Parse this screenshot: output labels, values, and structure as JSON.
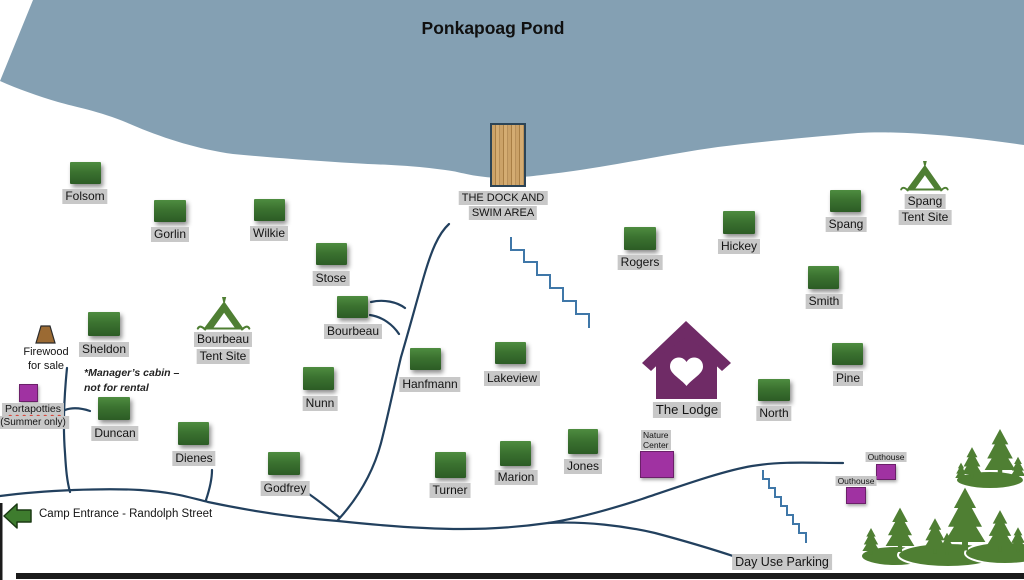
{
  "title": "Ponkapoag Pond",
  "dock": {
    "label_line1": "THE DOCK AND",
    "label_line2": "SWIM AREA"
  },
  "cabins": [
    {
      "name": "Folsom"
    },
    {
      "name": "Gorlin"
    },
    {
      "name": "Wilkie"
    },
    {
      "name": "Stose"
    },
    {
      "name": "Bourbeau"
    },
    {
      "name": "Rogers"
    },
    {
      "name": "Hickey"
    },
    {
      "name": "Spang"
    },
    {
      "name": "Smith"
    },
    {
      "name": "Pine"
    },
    {
      "name": "North"
    },
    {
      "name": "Sheldon"
    },
    {
      "name": "Duncan"
    },
    {
      "name": "Dienes"
    },
    {
      "name": "Godfrey"
    },
    {
      "name": "Nunn"
    },
    {
      "name": "Hanfmann"
    },
    {
      "name": "Lakeview"
    },
    {
      "name": "Turner"
    },
    {
      "name": "Marion"
    },
    {
      "name": "Jones"
    }
  ],
  "tent_sites": [
    {
      "line1": "Bourbeau",
      "line2": "Tent Site"
    },
    {
      "line1": "Spang",
      "line2": "Tent Site"
    }
  ],
  "lodge": {
    "label": "The Lodge"
  },
  "facilities": {
    "nature_center": {
      "line1": "Nature",
      "line2": "Center"
    },
    "outhouse_upper": {
      "label": "Outhouse"
    },
    "outhouse_lower": {
      "label": "Outhouse"
    },
    "portapotties": {
      "line1": "Portapotties",
      "line2": "(Summer only)"
    }
  },
  "firewood": {
    "line1": "Firewood",
    "line2": "for sale"
  },
  "manager_note": {
    "line1": "*Manager’s cabin –",
    "line2": "not  for rental"
  },
  "entrance": {
    "label": "Camp Entrance - Randolph Street"
  },
  "day_use_parking": {
    "label": "Day Use Parking"
  },
  "colors": {
    "water": "#84a0b3",
    "cabin_green": "#3b7230",
    "tree_green": "#4f7f33",
    "facility_purple": "#a032a2",
    "lodge_purple": "#6f2b66",
    "path_navy": "#22405e",
    "stairs_blue": "#3f77a8",
    "label_gray": "#c8c8c8",
    "arrow_green": "#3e7c2e",
    "dock_wood": "#cba268"
  }
}
